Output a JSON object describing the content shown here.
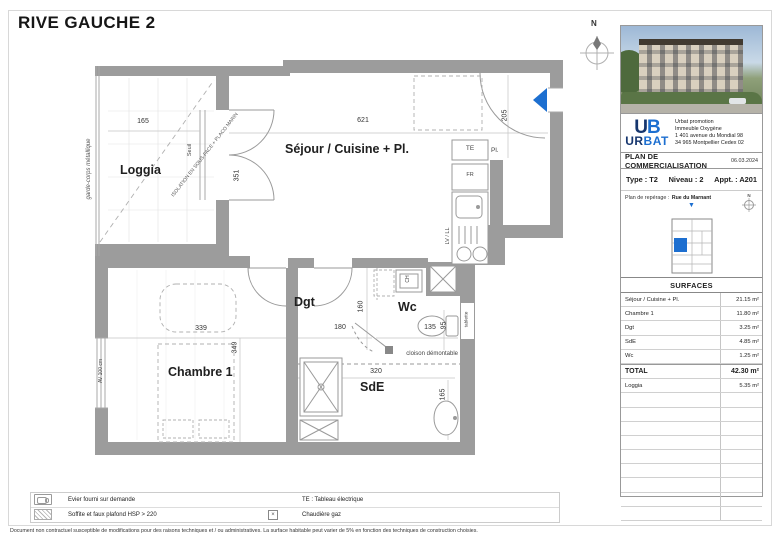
{
  "title": "RIVE GAUCHE 2",
  "floorplan": {
    "north": "N",
    "rooms": {
      "loggia": "Loggia",
      "sejour": "Séjour / Cuisine + Pl.",
      "chambre": "Chambre 1",
      "dgt": "Dgt",
      "wc": "Wc",
      "sde": "SdE"
    },
    "dims": {
      "loggia_w": "165",
      "loggia_door": "351",
      "sejour_w": "621",
      "entree": "205",
      "chambre_w": "339",
      "chambre_h": "349",
      "dgt_w": "180",
      "dgt_h": "160",
      "wc_w": "135",
      "wc_h": "95",
      "sde_w": "320",
      "sde_h": "165"
    },
    "notes": {
      "isolation": "ISOLATION EN SOUS-FACE + PLACO MARIN",
      "garde_corps": "garde-corps métallique",
      "seuil": "Seuil",
      "av": "AV 100 cm",
      "cloison": "cloison démontable",
      "tablette": "tablette",
      "te": "TE",
      "pl": "Pl.",
      "fr": "FR",
      "lv_ll": "LV / LL",
      "ch": "CH"
    }
  },
  "sidebar": {
    "logo": {
      "u": "U",
      "b": "B",
      "ur": "UR",
      "bat": "BAT"
    },
    "address": [
      "Urbat promotion",
      "Immeuble Oxygène",
      "1 401 avenue du Mondial 98",
      "34 965 Montpellier Cedex 02"
    ],
    "plan_title": "PLAN DE COMMERCIALISATION",
    "date": "06.03.2024",
    "unit": {
      "type": "Type : T2",
      "niveau": "Niveau : 2",
      "appt": "Appt. : A201"
    },
    "reperage": {
      "label": "Plan de repérage :",
      "street": "Rue du Marnant",
      "north": "N"
    },
    "surfaces": {
      "header": "SURFACES",
      "rows": [
        {
          "label": "Séjour / Cuisine + Pl.",
          "value": "21.15 m²"
        },
        {
          "label": "Chambre 1",
          "value": "11.80 m²"
        },
        {
          "label": "Dgt",
          "value": "3.25 m²"
        },
        {
          "label": "SdE",
          "value": "4.85 m²"
        },
        {
          "label": "Wc",
          "value": "1.25 m²"
        },
        {
          "label": "TOTAL",
          "value": "42.30 m²"
        },
        {
          "label": "Loggia",
          "value": "5.35 m²"
        }
      ]
    }
  },
  "legend": {
    "evier": "Evier fourni sur demande",
    "soffite": "Soffite et faux plafond HSP > 220",
    "te": "TE : Tableau électrique",
    "chaudiere": "Chaudière gaz"
  },
  "disclaimer": "Document non contractuel susceptible de modifications pour des raisons techniques et / ou administratives. La surface habitable peut varier de 5% en fonction des techniques de construction choisies.",
  "colors": {
    "accent": "#1d6fd0",
    "wall": "#9c9c9c"
  }
}
